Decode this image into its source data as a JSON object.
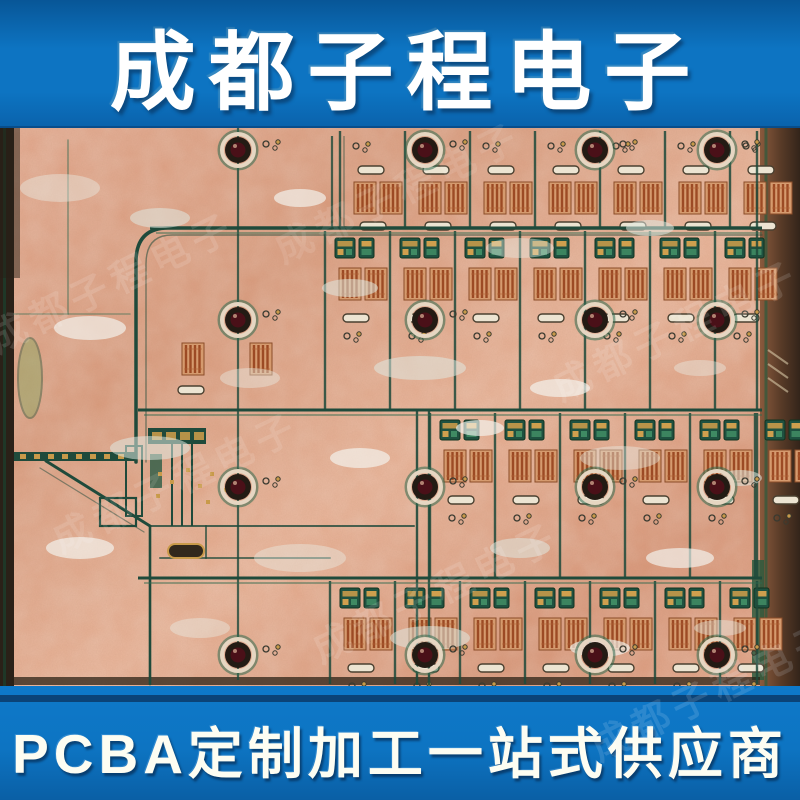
{
  "top_banner": {
    "text": "成都子程电子"
  },
  "bottom_banner": {
    "text": "PCBA定制加工一站式供应商"
  },
  "watermark": {
    "text": "成都子程电子"
  },
  "colors": {
    "banner_blue": "#0d74c2",
    "banner_blue_dark": "#085697",
    "banner_navy_line": "#0a3a69",
    "text_white": "#ffffff",
    "copper_base": "#dfa287",
    "copper_dark": "#c98a6d",
    "trace_green": "#1f4a3b",
    "trace_green_bright": "#2f6a4f",
    "pad_gold": "#c89a4a",
    "grid_rust": "#9c4a24",
    "solder_white": "#e9efe8",
    "hole_dark": "#241a12",
    "hole_inner_red": "#4a1018",
    "panel_edge_dark": "#2a2118"
  }
}
